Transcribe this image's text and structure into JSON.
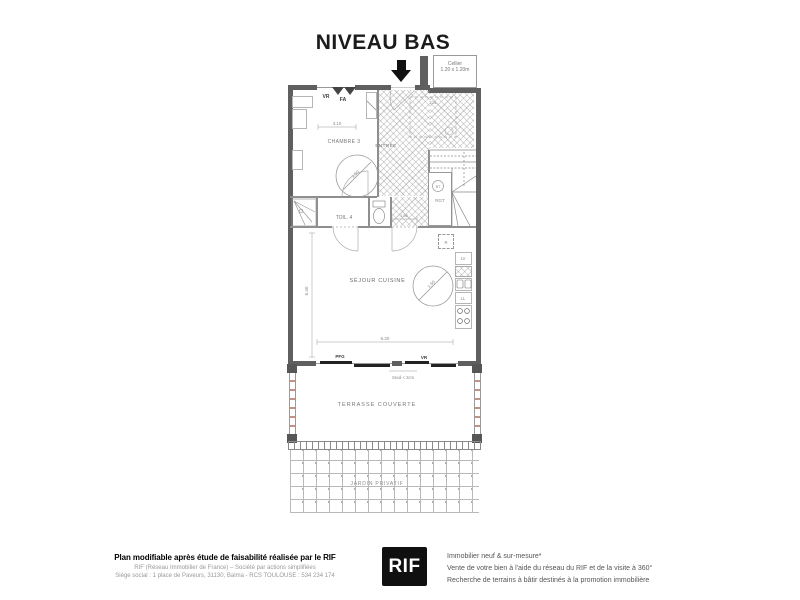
{
  "title": "NIVEAU BAS",
  "plan": {
    "cellier": {
      "name": "Cellier",
      "dim": "1.20 x 1.20m"
    },
    "rooms": {
      "chambre": "CHAMBRE 3",
      "entree": "ENTRÉE",
      "toilette": "TOIL. 4",
      "sejour": "SÉJOUR CUISINE",
      "terrasse": "TERRASSE COUVERTE",
      "jardin": "JARDIN PRIVATIF"
    },
    "openings": {
      "vr_top": "VR",
      "fa_top": "FA",
      "pfg_bottom": "PFG",
      "vr_bottom": "VR"
    },
    "equipment": {
      "bt": "BT",
      "rgt": "RGT",
      "r": "R",
      "lv": "LV",
      "ll": "LL",
      "tol": "TOL"
    },
    "dimensions": {
      "chambre_width": "3.10",
      "turn_circle_chambre": "1.50",
      "hall_width": "1.50",
      "sejour_height": "6.40",
      "sejour_width": "6.20",
      "turn_circle_sejour": "1.50",
      "seuil": "Seuil < 2cm"
    }
  },
  "footer": {
    "left": {
      "line1": "Plan modifiable après étude de faisabilité réalisée par le RIF",
      "line2": "RIF (Réseau Immobilier de France) – Société par actions simplifiées",
      "line3": "Siège social : 1 place de Paveurs, 31130, Balma - RCS TOULOUSE : 534 234 174"
    },
    "logo": "RIF",
    "right": {
      "line1": "Immobilier neuf & sur-mesure*",
      "line2": "Vente de votre bien à l'aide du réseau du RIF et de la visite à 360°",
      "line3": "Recherche de terrains à bâtir destinés à la promotion immobilière"
    }
  }
}
